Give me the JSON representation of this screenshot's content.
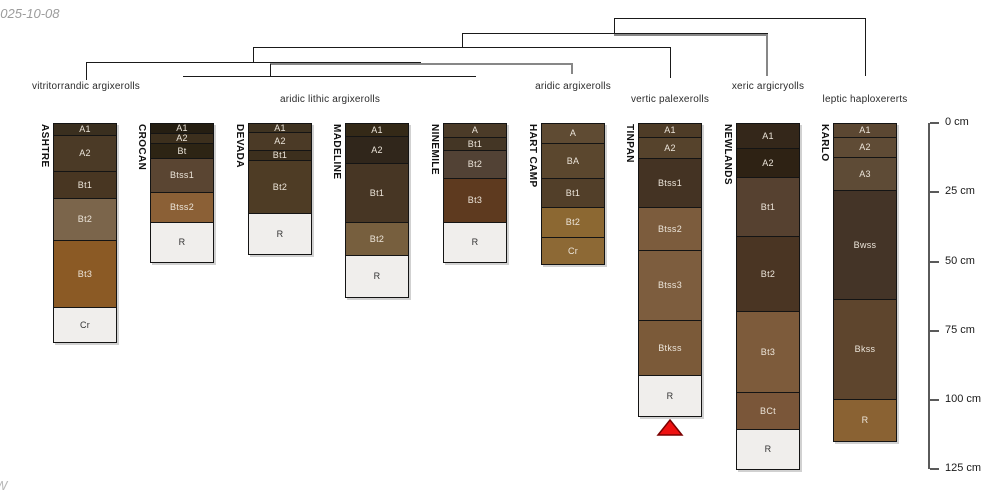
{
  "meta": {
    "date_text": "2025-10-08",
    "watermark_text": "W"
  },
  "chart_data": {
    "type": "table",
    "title": "Soil taxonomy dendrogram with soil profile sketches",
    "depth_axis": {
      "unit": "cm",
      "tick_labels": [
        "0 cm",
        "25 cm",
        "50 cm",
        "75 cm",
        "100 cm",
        "125 cm"
      ],
      "tick_values": [
        0,
        25,
        50,
        75,
        100,
        125
      ],
      "axis_x_px": 928,
      "top_px": 123,
      "px_per_cm": 2.77
    },
    "subgroups": [
      {
        "label": "vitritorrandic argixerolls",
        "cx": 86,
        "y": 81
      },
      {
        "label": "aridic lithic argixerolls",
        "cx": 330,
        "y": 94
      },
      {
        "label": "aridic argixerolls",
        "cx": 573,
        "y": 81
      },
      {
        "label": "vertic palexerolls",
        "cx": 670,
        "y": 94
      },
      {
        "label": "xeric argicryolls",
        "cx": 768,
        "y": 81
      },
      {
        "label": "leptic haploxererts",
        "cx": 865,
        "y": 94
      }
    ],
    "dendrogram_segments": [
      {
        "x": 614,
        "y": 18,
        "w": 252,
        "h": 1,
        "gray": false
      },
      {
        "x": 865,
        "y": 18,
        "w": 1,
        "h": 58,
        "gray": false
      },
      {
        "x": 614,
        "y": 18,
        "w": 1,
        "h": 15,
        "gray": false
      },
      {
        "x": 462,
        "y": 33,
        "w": 306,
        "h": 1,
        "gray": false
      },
      {
        "x": 614,
        "y": 34,
        "w": 154,
        "h": 2,
        "gray": true
      },
      {
        "x": 766,
        "y": 34,
        "w": 2,
        "h": 42,
        "gray": true
      },
      {
        "x": 462,
        "y": 33,
        "w": 1,
        "h": 14,
        "gray": false
      },
      {
        "x": 253,
        "y": 47,
        "w": 418,
        "h": 1,
        "gray": false
      },
      {
        "x": 670,
        "y": 47,
        "w": 1,
        "h": 31,
        "gray": false
      },
      {
        "x": 253,
        "y": 47,
        "w": 1,
        "h": 15,
        "gray": false
      },
      {
        "x": 86,
        "y": 62,
        "w": 335,
        "h": 1,
        "gray": false
      },
      {
        "x": 270,
        "y": 63,
        "w": 303,
        "h": 2,
        "gray": true
      },
      {
        "x": 571,
        "y": 64,
        "w": 2,
        "h": 10,
        "gray": true
      },
      {
        "x": 270,
        "y": 64,
        "w": 1,
        "h": 12,
        "gray": false
      },
      {
        "x": 86,
        "y": 62,
        "w": 1,
        "h": 18,
        "gray": false
      },
      {
        "x": 183,
        "y": 76,
        "w": 293,
        "h": 1,
        "gray": false
      }
    ],
    "profiles": [
      {
        "name": "ASHTRE",
        "subgroup": "vitritorrandic argixerolls",
        "x": 53,
        "w": 64,
        "top": 123,
        "horizons": [
          {
            "name": "A1",
            "top_cm": 0,
            "bottom_cm": 4,
            "h": 12,
            "color": "#3a2f1f"
          },
          {
            "name": "A2",
            "top_cm": 4,
            "bottom_cm": 17,
            "h": 36,
            "color": "#4b3a26"
          },
          {
            "name": "Bt1",
            "top_cm": 17,
            "bottom_cm": 27,
            "h": 27,
            "color": "#483622"
          },
          {
            "name": "Bt2",
            "top_cm": 27,
            "bottom_cm": 42,
            "h": 42,
            "color": "#7b654b"
          },
          {
            "name": "Bt3",
            "top_cm": 42,
            "bottom_cm": 66,
            "h": 67,
            "color": "#8b5a25"
          },
          {
            "name": "Cr",
            "top_cm": 66,
            "bottom_cm": 79,
            "h": 36,
            "color": "#f0eeec"
          }
        ]
      },
      {
        "name": "CROCAN",
        "subgroup": "aridic lithic argixerolls",
        "x": 150,
        "w": 64,
        "top": 123,
        "horizons": [
          {
            "name": "A1",
            "top_cm": 0,
            "bottom_cm": 4,
            "h": 10,
            "color": "#251e12"
          },
          {
            "name": "A2",
            "top_cm": 4,
            "bottom_cm": 7,
            "h": 10,
            "color": "#3c2f1d"
          },
          {
            "name": "Bt",
            "top_cm": 7,
            "bottom_cm": 13,
            "h": 15,
            "color": "#2d2414"
          },
          {
            "name": "Btss1",
            "top_cm": 13,
            "bottom_cm": 25,
            "h": 34,
            "color": "#5a4532"
          },
          {
            "name": "Btss2",
            "top_cm": 25,
            "bottom_cm": 36,
            "h": 30,
            "color": "#8b6036"
          },
          {
            "name": "R",
            "top_cm": 36,
            "bottom_cm": 51,
            "h": 41,
            "color": "#f0eeec"
          }
        ]
      },
      {
        "name": "DEVADA",
        "subgroup": "aridic lithic argixerolls",
        "x": 248,
        "w": 64,
        "top": 123,
        "horizons": [
          {
            "name": "A1",
            "top_cm": 0,
            "bottom_cm": 3,
            "h": 9,
            "color": "#3f3321"
          },
          {
            "name": "A2",
            "top_cm": 3,
            "bottom_cm": 10,
            "h": 18,
            "color": "#4b3a26"
          },
          {
            "name": "Bt1",
            "top_cm": 10,
            "bottom_cm": 13,
            "h": 10,
            "color": "#3c2f1d"
          },
          {
            "name": "Bt2",
            "top_cm": 13,
            "bottom_cm": 33,
            "h": 53,
            "color": "#4e3c25"
          },
          {
            "name": "R",
            "top_cm": 33,
            "bottom_cm": 48,
            "h": 42,
            "color": "#f0eeec"
          }
        ]
      },
      {
        "name": "MADELINE",
        "subgroup": "aridic lithic argixerolls",
        "x": 345,
        "w": 64,
        "top": 123,
        "horizons": [
          {
            "name": "A1",
            "top_cm": 0,
            "bottom_cm": 5,
            "h": 13,
            "color": "#342917"
          },
          {
            "name": "A2",
            "top_cm": 5,
            "bottom_cm": 14,
            "h": 27,
            "color": "#30261b"
          },
          {
            "name": "Bt1",
            "top_cm": 14,
            "bottom_cm": 36,
            "h": 59,
            "color": "#473624"
          },
          {
            "name": "Bt2",
            "top_cm": 36,
            "bottom_cm": 48,
            "h": 33,
            "color": "#775f3e"
          },
          {
            "name": "R",
            "top_cm": 48,
            "bottom_cm": 63,
            "h": 43,
            "color": "#f0eeec"
          }
        ]
      },
      {
        "name": "NINEMILE",
        "subgroup": "aridic lithic argixerolls",
        "x": 443,
        "w": 64,
        "top": 123,
        "horizons": [
          {
            "name": "A",
            "top_cm": 0,
            "bottom_cm": 5,
            "h": 14,
            "color": "#4b3b28"
          },
          {
            "name": "Bt1",
            "top_cm": 5,
            "bottom_cm": 10,
            "h": 13,
            "color": "#443625"
          },
          {
            "name": "Bt2",
            "top_cm": 10,
            "bottom_cm": 20,
            "h": 28,
            "color": "#524235"
          },
          {
            "name": "Bt3",
            "top_cm": 20,
            "bottom_cm": 36,
            "h": 44,
            "color": "#5e3a1f"
          },
          {
            "name": "R",
            "top_cm": 36,
            "bottom_cm": 51,
            "h": 41,
            "color": "#f0eeec"
          }
        ]
      },
      {
        "name": "HART CAMP",
        "subgroup": "aridic argixerolls",
        "x": 541,
        "w": 64,
        "top": 123,
        "horizons": [
          {
            "name": "A",
            "top_cm": 0,
            "bottom_cm": 7,
            "h": 20,
            "color": "#5f4b33"
          },
          {
            "name": "BA",
            "top_cm": 7,
            "bottom_cm": 20,
            "h": 35,
            "color": "#5b472e"
          },
          {
            "name": "Bt1",
            "top_cm": 20,
            "bottom_cm": 30,
            "h": 29,
            "color": "#523f29"
          },
          {
            "name": "Bt2",
            "top_cm": 30,
            "bottom_cm": 41,
            "h": 30,
            "color": "#8c6832"
          },
          {
            "name": "Cr",
            "top_cm": 41,
            "bottom_cm": 51,
            "h": 28,
            "color": "#8d6935"
          }
        ]
      },
      {
        "name": "TINPAN",
        "subgroup": "vertic palexerolls",
        "x": 638,
        "w": 64,
        "top": 123,
        "marker": "red-triangle",
        "horizons": [
          {
            "name": "A1",
            "top_cm": 0,
            "bottom_cm": 5,
            "h": 14,
            "color": "#4e3c27"
          },
          {
            "name": "A2",
            "top_cm": 5,
            "bottom_cm": 13,
            "h": 21,
            "color": "#56432c"
          },
          {
            "name": "Btss1",
            "top_cm": 13,
            "bottom_cm": 30,
            "h": 49,
            "color": "#443323"
          },
          {
            "name": "Btss2",
            "top_cm": 30,
            "bottom_cm": 46,
            "h": 43,
            "color": "#7c5c3d"
          },
          {
            "name": "Btss3",
            "top_cm": 46,
            "bottom_cm": 71,
            "h": 70,
            "color": "#7d5d3e"
          },
          {
            "name": "Btkss",
            "top_cm": 71,
            "bottom_cm": 91,
            "h": 55,
            "color": "#7b5a39"
          },
          {
            "name": "R",
            "top_cm": 91,
            "bottom_cm": 106,
            "h": 42,
            "color": "#f0eeec"
          }
        ]
      },
      {
        "name": "NEWLANDS",
        "subgroup": "xeric argicryolls",
        "x": 736,
        "w": 64,
        "top": 123,
        "horizons": [
          {
            "name": "A1",
            "top_cm": 0,
            "bottom_cm": 9,
            "h": 25,
            "color": "#34271a"
          },
          {
            "name": "A2",
            "top_cm": 9,
            "bottom_cm": 20,
            "h": 29,
            "color": "#2e2214"
          },
          {
            "name": "Bt1",
            "top_cm": 20,
            "bottom_cm": 41,
            "h": 59,
            "color": "#564130"
          },
          {
            "name": "Bt2",
            "top_cm": 41,
            "bottom_cm": 68,
            "h": 75,
            "color": "#4a3523"
          },
          {
            "name": "Bt3",
            "top_cm": 68,
            "bottom_cm": 97,
            "h": 81,
            "color": "#7d5b3b"
          },
          {
            "name": "BCt",
            "top_cm": 97,
            "bottom_cm": 111,
            "h": 37,
            "color": "#7a5639"
          },
          {
            "name": "R",
            "top_cm": 111,
            "bottom_cm": 125,
            "h": 41,
            "color": "#f0eeec"
          }
        ]
      },
      {
        "name": "KARLO",
        "subgroup": "leptic haploxererts",
        "x": 833,
        "w": 64,
        "top": 123,
        "horizons": [
          {
            "name": "A1",
            "top_cm": 0,
            "bottom_cm": 5,
            "h": 14,
            "color": "#5b4732"
          },
          {
            "name": "A2",
            "top_cm": 5,
            "bottom_cm": 12,
            "h": 20,
            "color": "#5f4b35"
          },
          {
            "name": "A3",
            "top_cm": 12,
            "bottom_cm": 24,
            "h": 33,
            "color": "#5e4b36"
          },
          {
            "name": "Bwss",
            "top_cm": 24,
            "bottom_cm": 64,
            "h": 109,
            "color": "#443427"
          },
          {
            "name": "Bkss",
            "top_cm": 64,
            "bottom_cm": 100,
            "h": 100,
            "color": "#5e452d"
          },
          {
            "name": "R",
            "top_cm": 100,
            "bottom_cm": 115,
            "h": 43,
            "color": "#8a6233"
          }
        ]
      }
    ],
    "marker_color": "#ee1111",
    "marker_border_color": "#7a0000"
  }
}
